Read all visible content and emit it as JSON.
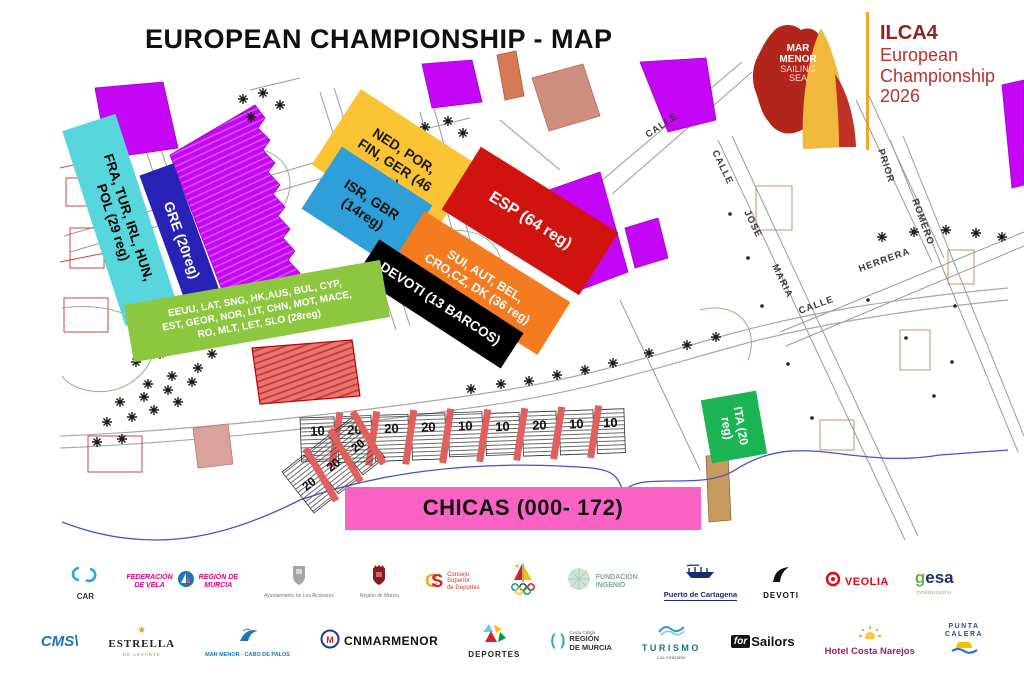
{
  "header": {
    "title": "EUROPEAN CHAMPIONSHIP - MAP"
  },
  "logo": {
    "badge_line1": "MAR",
    "badge_line2": "MENOR",
    "badge_line3": "SAILING",
    "badge_line4": "SEA",
    "event_title": "ILCA4",
    "event_line1": "European",
    "event_line2": "Championship",
    "event_line3": "2026",
    "colors": {
      "badge_red": "#b1251c",
      "sail_yellow": "#f0b93b",
      "sail_red": "#bf3127",
      "divider": "#f5a623"
    }
  },
  "map": {
    "zones": [
      {
        "id": "fra",
        "label": "FRA, TUR, IRL, HUN,\nPOL (29 reg)",
        "color": "#57d7dd",
        "text_color": "#000000"
      },
      {
        "id": "gre",
        "label": "GRE (20reg)",
        "color": "#2722b5",
        "text_color": "#ffffff"
      },
      {
        "id": "ned",
        "label": "NED, POR,\nFIN, GER (46\nreg)",
        "color": "#f9c333",
        "text_color": "#1a1a1a"
      },
      {
        "id": "isr",
        "label": "ISR, GBR\n(14reg)",
        "color": "#2f9fd9",
        "text_color": "#111111"
      },
      {
        "id": "esp",
        "label": "ESP (64 reg)",
        "color": "#d11310",
        "text_color": "#ffffff"
      },
      {
        "id": "sui",
        "label": "SUI, AUT, BEL,\nCRO,CZ, DK (36 reg)",
        "color": "#f57b20",
        "text_color": "#ffffff"
      },
      {
        "id": "devoti",
        "label": "DEVOTI (13 BARCOS)",
        "color": "#000000",
        "text_color": "#ffffff"
      },
      {
        "id": "countries",
        "label": "EEUU, LAT, SNG, HK,AUS, BUL, CYP,\nEST, GEOR, NOR, LIT, CHN, MOT, MACE,\nRO, MLT, LET, SLO (28reg)",
        "color": "#8dc63f",
        "text_color": "#ffffff"
      },
      {
        "id": "ita",
        "label": "ITA (20\nreg)",
        "color": "#1cb355",
        "text_color": "#ffffff"
      },
      {
        "id": "chicas",
        "label": "CHICAS (000- 172)",
        "color": "#fa62c4",
        "text_color": "#111111"
      }
    ],
    "street_names": [
      "CALLE",
      "CALLE",
      "JOSE",
      "MARIA",
      "CALLE",
      "HERRERA",
      "ROMERO",
      "PRIOR"
    ],
    "rack_numbers_main": [
      "10",
      "20",
      "20",
      "20",
      "10",
      "10",
      "20",
      "10",
      "10"
    ],
    "rack_numbers_side": [
      "20",
      "20",
      "20"
    ],
    "colors": {
      "building_magenta": "#c505f5",
      "building_red": "#e25b5b",
      "rack_stripe": "#e06060",
      "shoreline_blue": "#4653c8"
    }
  },
  "sponsors": {
    "row1": [
      {
        "id": "car",
        "icon": "car-swirl-icon",
        "label": "CAR"
      },
      {
        "id": "federacion-vela",
        "icon": "sail-circle-icon",
        "label_a": "FEDERACIÓN\nDE VELA",
        "label_b": "REGIÓN DE\nMURCIA"
      },
      {
        "id": "ayuntamiento",
        "icon": "town-crest-icon",
        "label": "Ayuntamiento de Los Alcázares"
      },
      {
        "id": "region-murcia-crest",
        "icon": "murcia-crest-icon",
        "label": "Región de Murcia"
      },
      {
        "id": "csd",
        "icon": "csd-monogram-icon",
        "label": "Consejo\nSuperior\nde Deportes"
      },
      {
        "id": "rfev",
        "icon": "olympic-sail-icon",
        "label": ""
      },
      {
        "id": "fundacion-ingenio",
        "icon": "green-sphere-icon",
        "label": "FUNDACIÓN\nINGENIO"
      },
      {
        "id": "puerto-cartagena",
        "icon": "galley-ship-icon",
        "label": "Puerto de Cartagena"
      },
      {
        "id": "devoti-sailing",
        "icon": "devoti-sail-icon",
        "label": "DEVOTI"
      },
      {
        "id": "veolia",
        "icon": "ring-dot-icon",
        "label": "VEOLIA"
      },
      {
        "id": "gesa",
        "icon": "gesa-wordmark",
        "label_a": "g",
        "label_b": "esa",
        "sub": "CORREDURÍA"
      }
    ],
    "row2": [
      {
        "id": "cms",
        "icon": "cms-wordmark",
        "label": "CMS\\"
      },
      {
        "id": "estrella-levante",
        "icon": "gold-star-icon",
        "label": "ESTRELLA",
        "sub": "DE LEVANTE"
      },
      {
        "id": "mar-menor-cabo",
        "icon": "wave-bird-icon",
        "label": "MAR MENOR - CABO DE PALOS"
      },
      {
        "id": "cnmarmenor",
        "icon": "club-badge-icon",
        "label": "CNMARMENOR"
      },
      {
        "id": "deportes",
        "icon": "mosaic-icon",
        "label": "DEPORTES"
      },
      {
        "id": "region-murcia-turismo",
        "icon": "brackets-icon",
        "sub": "Costa Cálida",
        "label": "REGIÓN\nDE MURCIA"
      },
      {
        "id": "turismo-alcazares",
        "icon": "double-wave-icon",
        "label": "TURISMO",
        "sub": "Los Alcázares"
      },
      {
        "id": "forsailors",
        "icon": "forsailors-wordmark",
        "label_a": "for",
        "label_b": "Sailors"
      },
      {
        "id": "hotel-costa-narejos",
        "icon": "sun-icon",
        "label": "Hotel Costa Narejos"
      },
      {
        "id": "punta-calera",
        "icon": "sun-wave-icon",
        "label": "PUNTA\nCALERA"
      }
    ]
  }
}
